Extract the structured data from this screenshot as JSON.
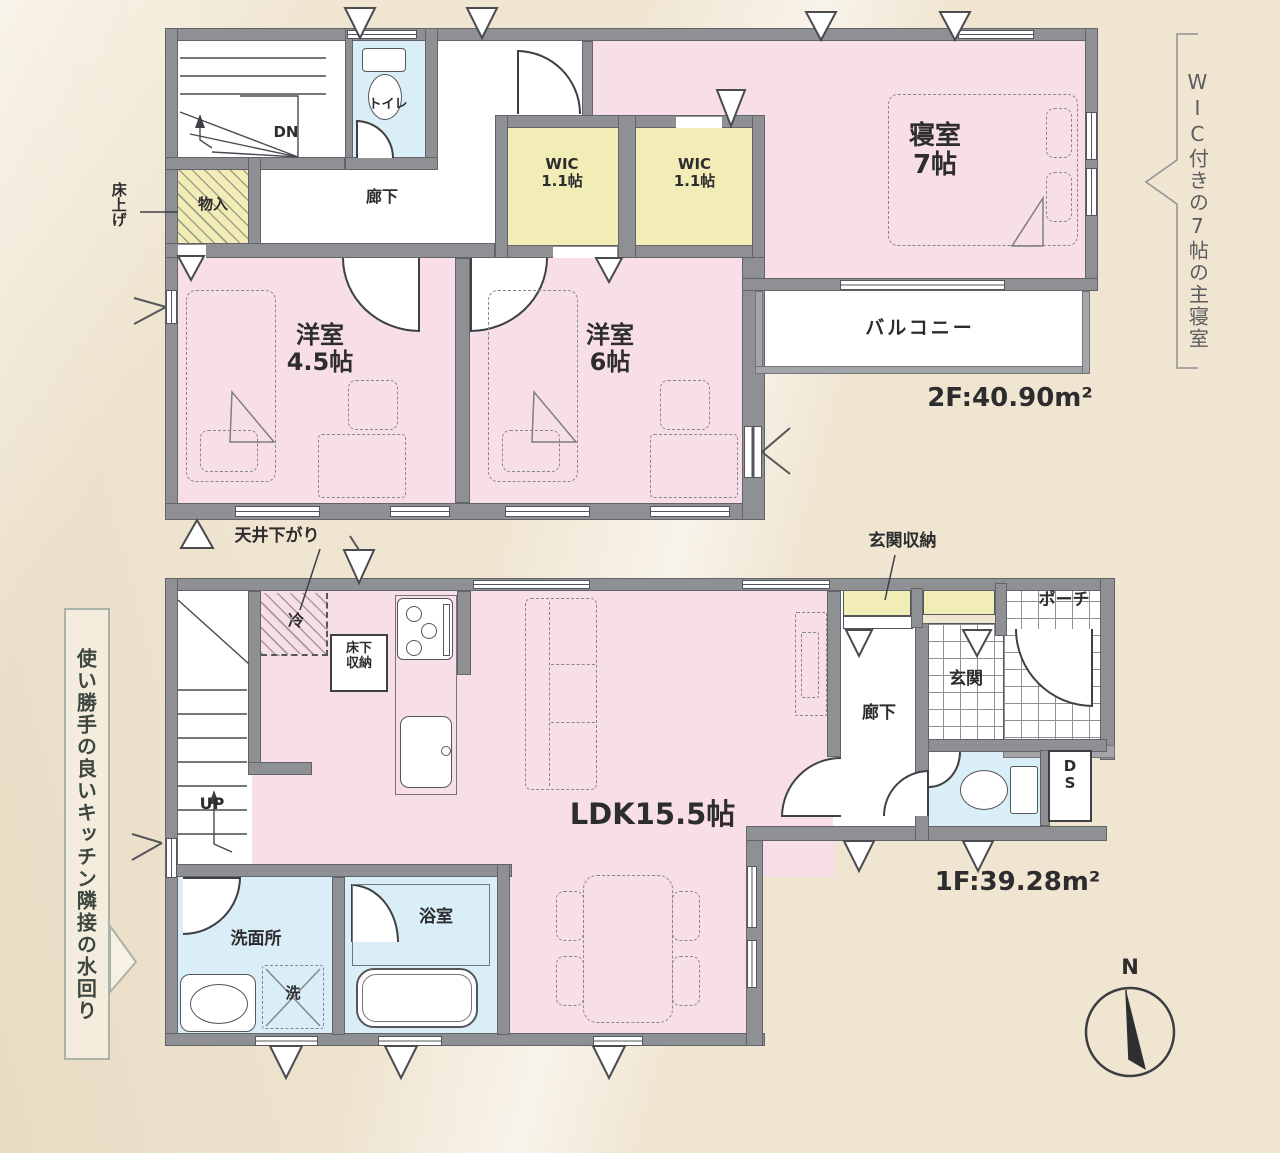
{
  "f2": {
    "dn": "DN",
    "toilet": "トイレ",
    "hall": "廊下",
    "storage": "物入",
    "floor_note": "床上げ",
    "wic1": "WIC\n1.1帖",
    "wic2": "WIC\n1.1帖",
    "bedroom": "寝室\n7帖",
    "room45": "洋室\n4.5帖",
    "room6": "洋室\n6帖",
    "balcony": "バルコニー",
    "area": "2F:40.90m²"
  },
  "f1": {
    "ceiling_note": "天井下がり",
    "fridge": "冷",
    "underfloor": "床下\n収納",
    "up": "UP",
    "ldk": "LDK15.5帖",
    "washroom": "洗面所",
    "washer": "洗",
    "bath": "浴室",
    "entry_note": "玄関収納",
    "entrance": "玄関",
    "porch": "ポーチ",
    "hall": "廊下",
    "duct": "D\nS",
    "area": "1F:39.28m²"
  },
  "notes": {
    "right": "WIC付きの7帖の主寝室",
    "left": "使い勝手の良いキッチン隣接の水回り"
  },
  "compass": {
    "n": "N"
  },
  "colors": {
    "wall": "#8e9094",
    "room_pink": "#f8dfe7",
    "wet_blue": "#d9eef6",
    "closet_yellow": "#f2edb6",
    "background": "#f0e5d1"
  }
}
